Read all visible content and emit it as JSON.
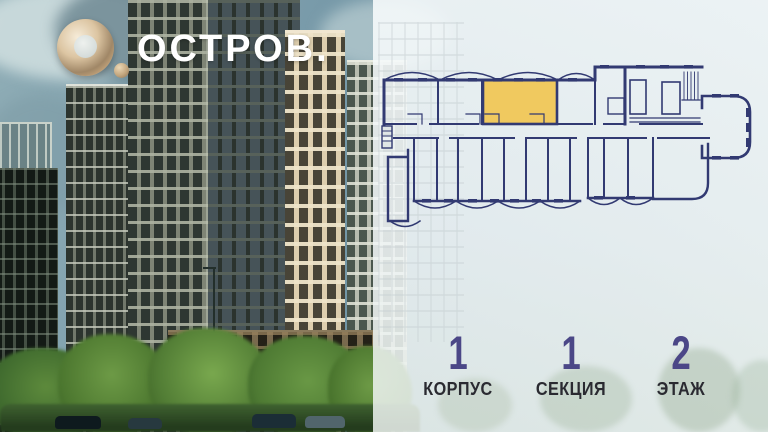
{
  "brand": {
    "name": "ОСТРОВ."
  },
  "floor_plan": {
    "line_color": "#323A72",
    "highlight_color": "#F0C95F",
    "highlighted_unit": "selected-apartment"
  },
  "stats": {
    "items": [
      {
        "value": "1",
        "label": "КОРПУС"
      },
      {
        "value": "1",
        "label": "СЕКЦИЯ"
      },
      {
        "value": "2",
        "label": "ЭТАЖ"
      }
    ]
  },
  "colors": {
    "logo_gold": "#C9A87E",
    "stat_value": "#4B4787",
    "stat_label": "#2A2A31",
    "overlay_panel": "#F3F8F9",
    "sky": "#7C9DAB"
  }
}
